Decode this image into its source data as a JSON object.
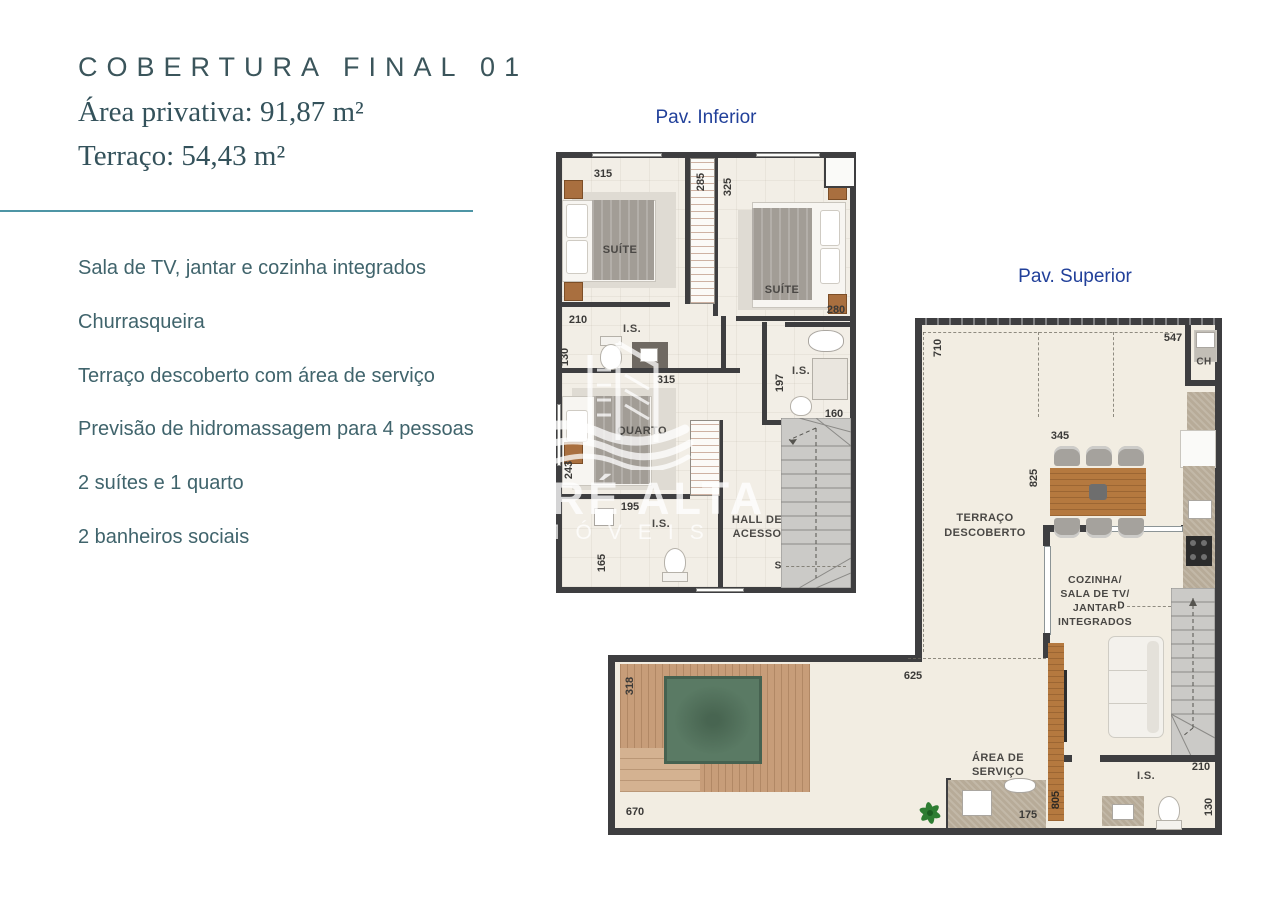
{
  "header": {
    "title": "COBERTURA FINAL 01",
    "area_privativa": "Área privativa: 91,87 m²",
    "terraco": "Terraço: 54,43 m²"
  },
  "features": [
    "Sala de TV, jantar e cozinha integrados",
    "Churrasqueira",
    "Terraço descoberto com área de serviço",
    "Previsão de hidromassagem para 4 pessoas",
    "2 suítes e 1 quarto",
    "2 banheiros sociais"
  ],
  "watermark": {
    "brand": "MARÉ ALTA",
    "suffix": "IMÓVEIS"
  },
  "colors": {
    "accent_teal": "#4e95a5",
    "heading_teal": "#3b555b",
    "plan_label_blue": "#21409a",
    "wall": "#3e3e40",
    "floor": "#f2eee6",
    "wood_deck": "#c79d79",
    "tub_green": "#5a7a64"
  },
  "plan_inferior": {
    "label": "Pav. Inferior",
    "rooms": {
      "suite1": "SUÍTE",
      "suite2": "SUÍTE",
      "is1": "I.S.",
      "is2": "I.S.",
      "is3": "I.S.",
      "quarto": "QUARTO",
      "hall_line1": "HALL DE",
      "hall_line2": "ACESSO"
    },
    "dims": {
      "suite1_top": "315",
      "closet": "285",
      "closet_side": "325",
      "suite1_bottom": "210",
      "is1_left": "130",
      "corridor": "315",
      "suite2_bottom": "280",
      "is2_left": "197",
      "is2_bottom": "160",
      "quarto_left": "243",
      "quarto_bottom": "195",
      "is3_left": "165"
    },
    "stair_marker": "S"
  },
  "plan_superior": {
    "label": "Pav. Superior",
    "rooms": {
      "terraco_line1": "TERRAÇO",
      "terraco_line2": "DESCOBERTO",
      "cozinha_line1": "COZINHA/",
      "cozinha_line2": "SALA DE TV/",
      "cozinha_line3": "JANTAR",
      "cozinha_line4": "INTEGRADOS",
      "area_line1": "ÁREA DE",
      "area_line2": "SERVIÇO",
      "is": "I.S.",
      "ch": "CH"
    },
    "dims": {
      "left": "710",
      "top": "547",
      "dining_top": "345",
      "dining_left": "825",
      "terrace_mid": "625",
      "deck_left": "318",
      "deck_bottom": "670",
      "area_servico": "175",
      "tv_wall": "805",
      "is_top": "210",
      "is_right": "130"
    },
    "stair_marker": "D"
  }
}
